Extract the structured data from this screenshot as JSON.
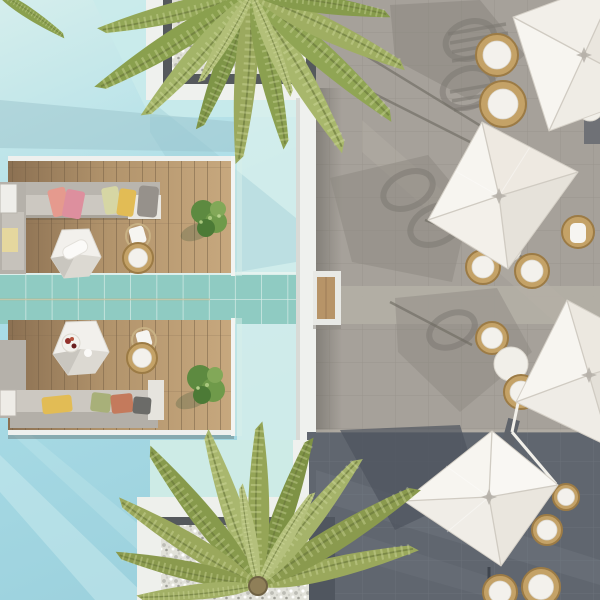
{
  "scene": {
    "description": "Aerial top-down view of a resort pool terrace: a turquoise pool with two floating timber lounge decks on the left, each with a grey sofa, colorful pillows, a white faceted coffee table, a rattan ring chair and green plants; a seafoam tiled walkway crosses the pool to a timber step; on the right a grey stone patio with four white square cantilever parasols over round rattan chairs, long palm and parasol shadows; white-framed pebble planters with overhanging palm trees at top and bottom."
  },
  "palette": {
    "water": "#abdde7",
    "water_light_zone": "#c9ebeb",
    "water_channel": "#daf0ec",
    "water_shelf": "#cdebe6",
    "teal_tiles": "#8fcbc2",
    "deck_wood": "#ab8c64",
    "white_coping": "#eff1ee",
    "patio_light": "#a6a19a",
    "patio_walkway": "#b4afa5",
    "patio_dark": "#60666f",
    "patio_corner_dark": "#676c72",
    "umbrella_canvas": "#f7f5f0",
    "umbrella_shade": "#e7e3db",
    "shadow_grey": "#827e76",
    "sofa_grey": "#b9b5ae",
    "seat_grey": "#ccc8c1",
    "rattan": "#c4a267",
    "cushion_white": "#f3f1ec",
    "pebbles": "#e1e1d9",
    "plant_green": "#6f9a4a",
    "palm_olive": "#9aa860",
    "step_wood": "#b79468",
    "pillow_salmon": "#e59a8e",
    "pillow_pink": "#dd8f9e",
    "pillow_yellow": "#e2bc55",
    "pillow_sage": "#a8b079",
    "pillow_rust": "#c47a5c",
    "pillow_grey": "#96918b"
  },
  "inventory": {
    "parasols": 4,
    "lounge_decks": 2,
    "sofas": 2,
    "coffee_tables": 2,
    "rattan_chairs": 13,
    "side_tables": 3,
    "palm_trees": 2,
    "pebble_planters": 2,
    "plants": 2
  }
}
